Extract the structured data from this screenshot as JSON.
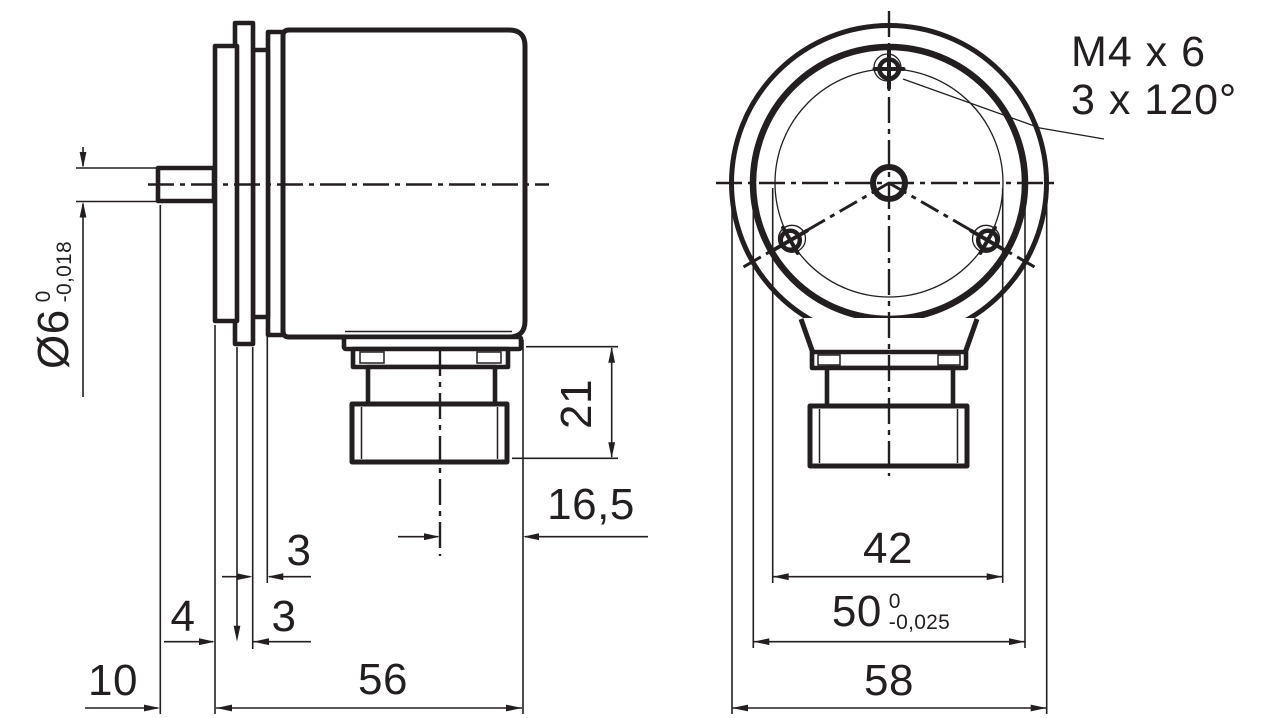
{
  "drawing": {
    "colors": {
      "ink": "#231f20",
      "paper": "#ffffff"
    },
    "side_view": {
      "dims": {
        "shaft_dia": "Ø6",
        "shaft_dia_tol_upper": "0",
        "shaft_dia_tol_lower": "-0,018",
        "shaft_length": "10",
        "flange_thickness": "4",
        "ring1_thickness": "3",
        "ring2_thickness": "3",
        "body_length": "56",
        "connector_center_offset": "16,5",
        "connector_height": "21"
      }
    },
    "front_view": {
      "dims": {
        "bolt_circle_dia": "42",
        "flange_dia": "50",
        "flange_dia_tol_upper": "0",
        "flange_dia_tol_lower": "-0,025",
        "body_dia": "58"
      },
      "note": {
        "line1": "M4 x 6",
        "line2": "3 x 120°"
      }
    }
  }
}
